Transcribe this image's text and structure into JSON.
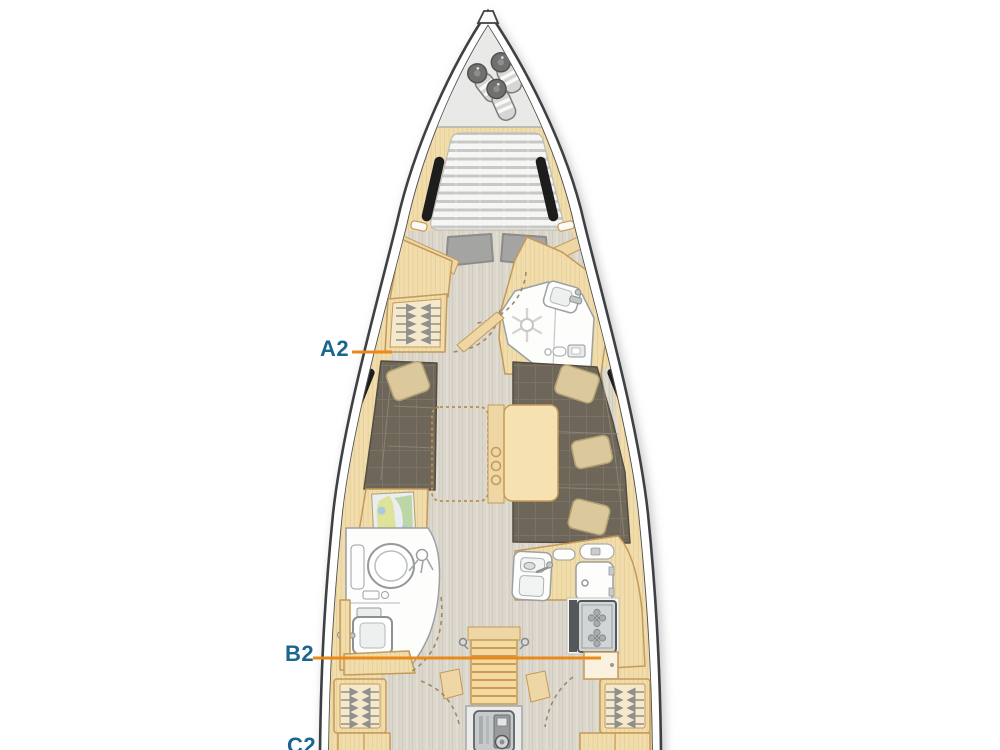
{
  "figure": {
    "kind": "sailing-yacht-interior-layout-plan",
    "canvas": {
      "width": 1000,
      "height": 750,
      "background": "#ffffff"
    },
    "colors": {
      "label_text": "#19678f",
      "leader_line": "#e8891a",
      "hull_outline": "#3d4145",
      "deck_rim": "#f0efeb",
      "wood": "#f1dcab",
      "wood_border": "#c49a58",
      "floor": "#dcd7cc",
      "sofa": "#6e6658",
      "pillow": "#dbc89d",
      "mattress": "#f6f6f5",
      "mattress_stripe": "#c8c8c6",
      "window_black": "#1d1d1d",
      "fixture_white": "#fdfdfc",
      "metal_gray": "#c7cacb"
    },
    "labels": [
      {
        "id": "A2",
        "text": "A2",
        "points_to": "port-wardrobe-forward"
      },
      {
        "id": "B2",
        "text": "B2",
        "points_to": "galley-aft-cabinet"
      },
      {
        "id": "C2",
        "text": "C2",
        "points_to": "aft-area-cut-off"
      }
    ],
    "areas": [
      "anchor-locker-with-fenders",
      "v-berth-double-bed",
      "hull-windows",
      "port-wardrobe-hanging-locker",
      "forward-head-shower-sink-toilet",
      "salon-settees-with-cushions",
      "folding-salon-table-with-bottle-holder",
      "chart-table-with-nautical-map",
      "aft-head-toilet-and-sink",
      "galley-sink-fridge-stove",
      "companionway-steps",
      "engine-compartment",
      "aft-cabin-wardrobes"
    ]
  }
}
